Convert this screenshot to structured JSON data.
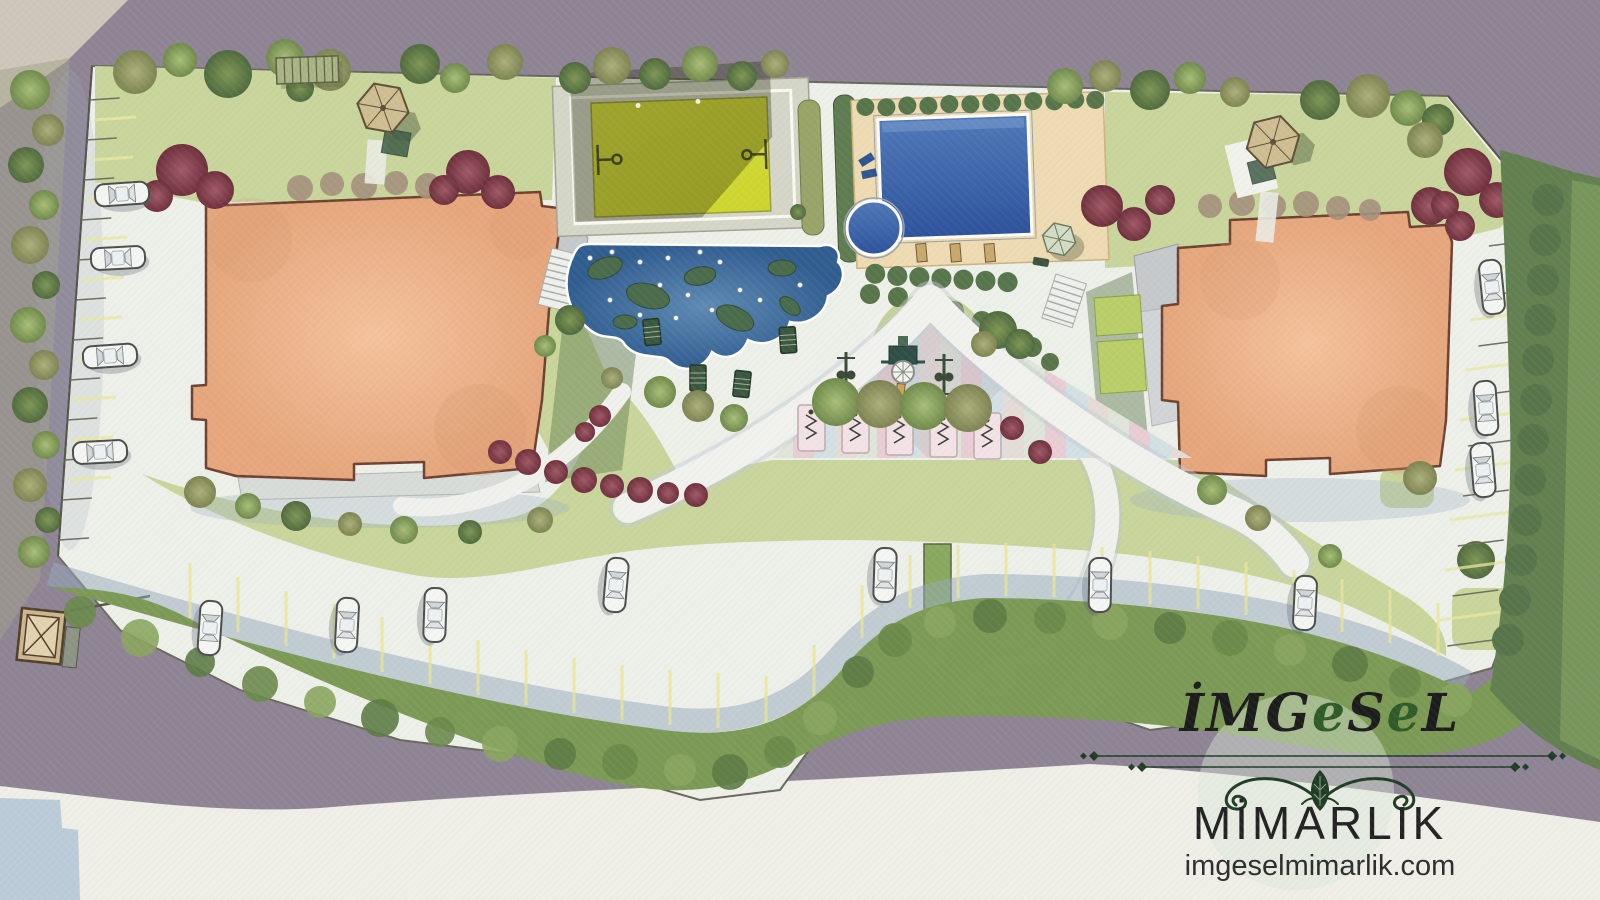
{
  "page": {
    "kind": "architectural-site-plan-rendering",
    "view": "top-down master plan, hand-rendered watercolor style"
  },
  "logo": {
    "title_parts": [
      "İMG",
      "e",
      "S",
      "e",
      "L"
    ],
    "subtitle": "MİMARLIK",
    "website": "imgeselmimarlik.com",
    "title_color_dark": "#1c1c1c",
    "title_color_green": "#2e5b28",
    "ornament_color": "#1f3d24",
    "ornament": "flourish-with-leaf"
  },
  "palette": {
    "outer_mauve": "#8e8494",
    "outer_cream": "#efeee7",
    "outer_blue_patch": "#b5c6d6",
    "paving": "#edefe9",
    "paving_shadow": "#96a9bc",
    "lawn": "#c8d59b",
    "hedge_dark": "#5c7a4e",
    "hedge_band": "#7c9a55",
    "tree_red": "#8b4150",
    "building_roof": "#edb38d",
    "building_outline": "#6e4130",
    "court_yellow": "#d7dd3d",
    "pool_blue": "#3c63a8",
    "pool_deck": "#eedbb2",
    "pond_blue": "#47749f",
    "playground_pink": "#e9cdd4",
    "stall_yellow": "#e6e79b",
    "car_body": "#f4f6f4"
  },
  "features": {
    "residential_blocks": 2,
    "basketball_court": 1,
    "swimming_pool": 1,
    "kids_pool": 1,
    "ornamental_pond": 1,
    "gazebos": 2,
    "pergola": 1,
    "entrance_kiosk": 1,
    "fitness_pads": 5,
    "sun_loungers": 3,
    "pool_umbrella": 1,
    "parked_cars": {
      "west_row": 4,
      "south_row": 7,
      "east_row": 3
    }
  }
}
